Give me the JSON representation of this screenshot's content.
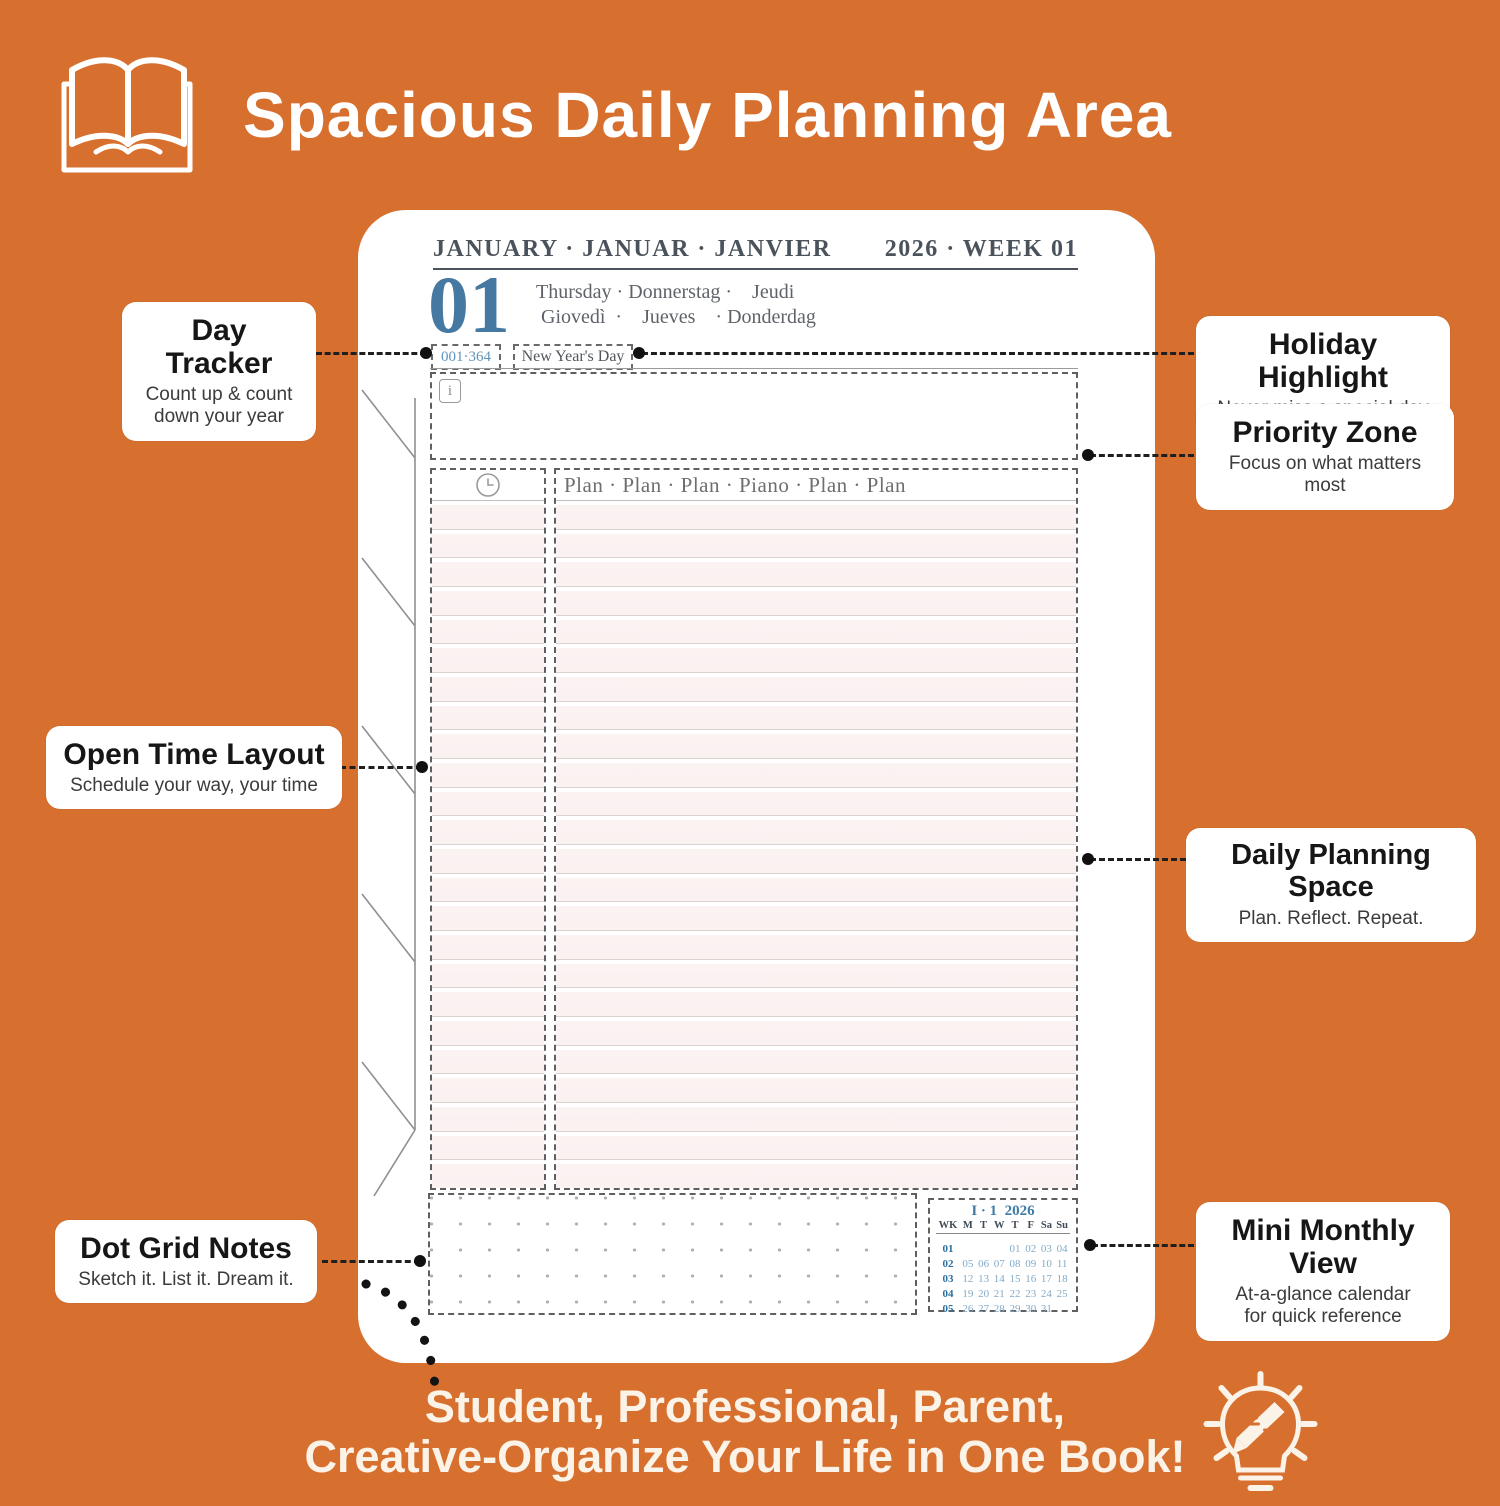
{
  "colors": {
    "background_orange": "#D7702F",
    "planner_blue": "#4579A1",
    "calendar_week_blue": "#2D6F9E",
    "calendar_day_blue": "#82ABC8",
    "callout_text": "#161616",
    "white": "#FFFFFF"
  },
  "banner": {
    "title": "Spacious Daily Planning Area",
    "icon": "open-book-icon"
  },
  "page": {
    "month_header": "JANUARY · JANUAR · JANVIER",
    "week_header": "2026 · WEEK 01",
    "day_number": "01",
    "weekday_line1": "Thursday · Donnerstag ·    Jeudi",
    "weekday_line2": " Giovedì  ·    Jueves    · Donderdag",
    "day_tracker": "001·364",
    "holiday_label": "New Year's Day",
    "priority_info_glyph": "i",
    "plan_header": "Plan · Plan · Plan · Piano · Plan · Plan",
    "schedule_row_count": 24,
    "mini_calendar": {
      "title": "I · 1  2026",
      "col_headers": [
        "WK",
        "M",
        "T",
        "W",
        "T",
        "F",
        "Sa",
        "Su"
      ],
      "weeks": [
        {
          "wk": "01",
          "days": [
            "",
            "",
            "",
            "01",
            "02",
            "03",
            "04"
          ]
        },
        {
          "wk": "02",
          "days": [
            "05",
            "06",
            "07",
            "08",
            "09",
            "10",
            "11"
          ]
        },
        {
          "wk": "03",
          "days": [
            "12",
            "13",
            "14",
            "15",
            "16",
            "17",
            "18"
          ]
        },
        {
          "wk": "04",
          "days": [
            "19",
            "20",
            "21",
            "22",
            "23",
            "24",
            "25"
          ]
        },
        {
          "wk": "05",
          "days": [
            "26",
            "27",
            "28",
            "29",
            "30",
            "31",
            ""
          ]
        }
      ]
    }
  },
  "callouts": {
    "day_tracker": {
      "title": "Day Tracker",
      "desc": "Count up & count\ndown your year"
    },
    "open_time": {
      "title": "Open Time Layout",
      "desc": "Schedule your way, your time"
    },
    "dot_grid": {
      "title": "Dot Grid Notes",
      "desc": "Sketch it. List it. Dream it."
    },
    "holiday": {
      "title": "Holiday Highlight",
      "desc": "Never miss a special day"
    },
    "priority": {
      "title": "Priority Zone",
      "desc": "Focus on what matters most"
    },
    "daily_space": {
      "title": "Daily Planning Space",
      "desc": "Plan. Reflect. Repeat."
    },
    "mini_monthly": {
      "title": "Mini Monthly View",
      "desc": "At-a-glance calendar\nfor quick reference"
    }
  },
  "footer": {
    "line1": "Student, Professional, Parent,",
    "line2": "Creative-Organize Your Life in One Book!",
    "icon": "lightbulb-pencil-icon"
  }
}
